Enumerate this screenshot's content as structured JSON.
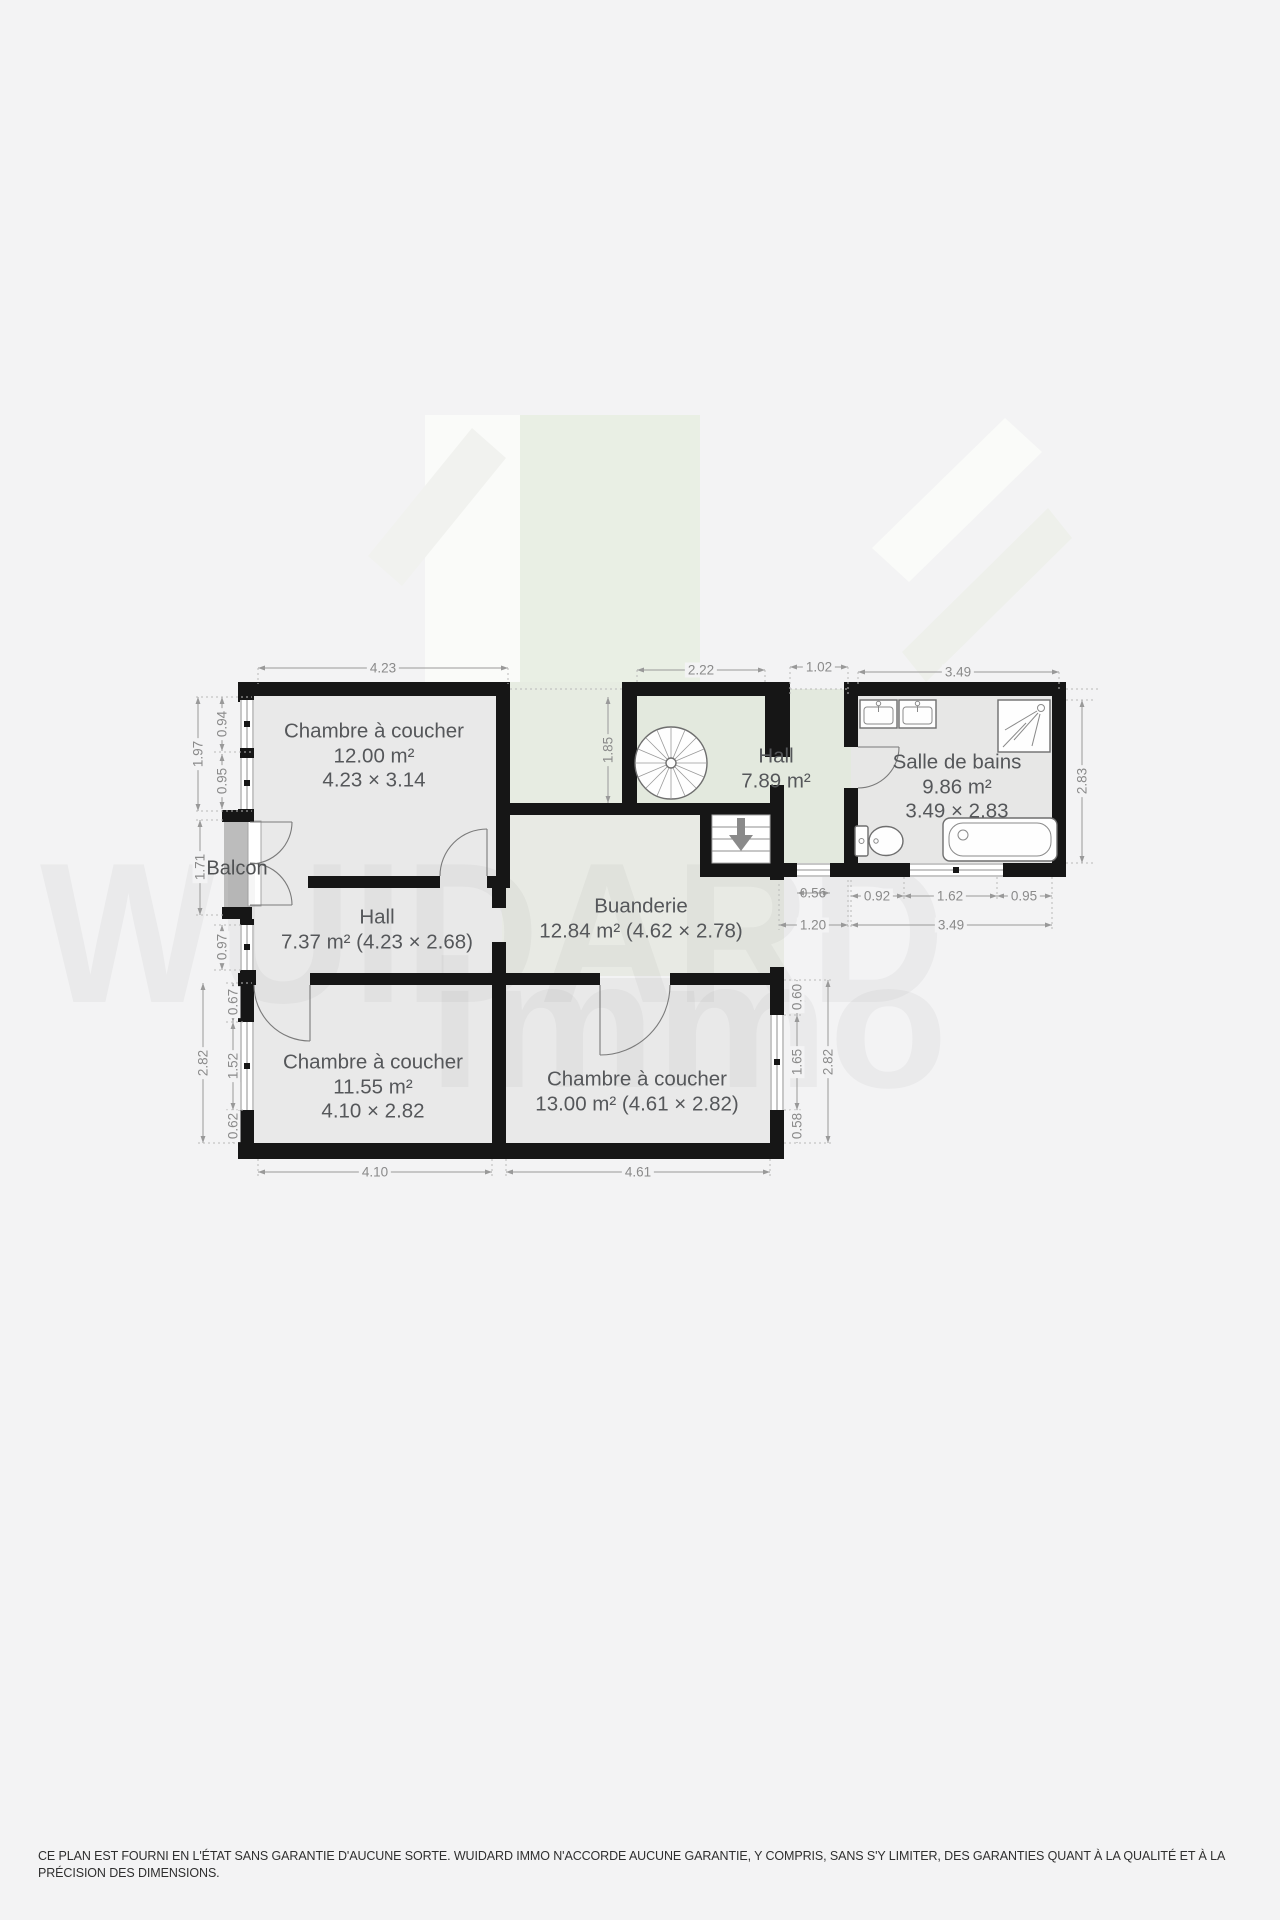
{
  "watermark": {
    "line1": "WUIDARD",
    "line2": "immo"
  },
  "rooms": {
    "bedroom_top": {
      "name": "Chambre à coucher",
      "area": "12.00 m²",
      "size": "4.23 × 3.14"
    },
    "hall_upper": {
      "name": "Hall",
      "area": "7.89 m²"
    },
    "bathroom": {
      "name": "Salle de bains",
      "area": "9.86 m²",
      "size": "3.49 × 2.83"
    },
    "balcony": {
      "name": "Balcon"
    },
    "hall_lower": {
      "name": "Hall",
      "details": "7.37 m² (4.23 × 2.68)"
    },
    "laundry": {
      "name": "Buanderie",
      "details": "12.84 m² (4.62 × 2.78)"
    },
    "bedroom_left": {
      "name": "Chambre à coucher",
      "area": "11.55 m²",
      "size": "4.10 × 2.82"
    },
    "bedroom_right": {
      "name": "Chambre à coucher",
      "details": "13.00 m² (4.61 × 2.82)"
    }
  },
  "dims": {
    "r1_top_width": "4.23",
    "hall_top_width": "2.22",
    "top_opening": "1.02",
    "bath_top_width": "3.49",
    "r1_left_total": "1.97",
    "r1_left_window1": "0.94",
    "r1_left_window2": "0.95",
    "balcony_height": "1.71",
    "hall_left_window": "0.97",
    "left_seg1": "0.67",
    "left_window": "1.52",
    "left_seg2": "0.62",
    "left_total": "2.82",
    "bottom_left_width": "4.10",
    "bottom_right_width": "4.61",
    "right_seg1": "0.60",
    "right_window": "1.65",
    "right_seg2": "0.58",
    "right_total": "2.82",
    "void_height": "1.85",
    "corridor_window": "0.56",
    "corridor_width": "1.20",
    "bath_bottom_seg1": "0.92",
    "bath_bottom_window": "1.62",
    "bath_bottom_seg3": "0.95",
    "bath_bottom_total": "3.49",
    "bath_right_height": "2.83"
  },
  "colors": {
    "wall": "#161616",
    "room_fill": "#e9e9e9",
    "hall_fill": "#e3e9de",
    "balcony_fill": "#bcbcbc",
    "dim_text": "#8a8a8a",
    "label_text": "#55575a",
    "background": "#f3f3f4"
  },
  "disclaimer": "CE PLAN EST FOURNI EN L'ÉTAT SANS GARANTIE D'AUCUNE SORTE. WUIDARD IMMO N'ACCORDE AUCUNE GARANTIE, Y COMPRIS, SANS S'Y LIMITER, DES GARANTIES QUANT À LA QUALITÉ ET À LA PRÉCISION DES DIMENSIONS."
}
